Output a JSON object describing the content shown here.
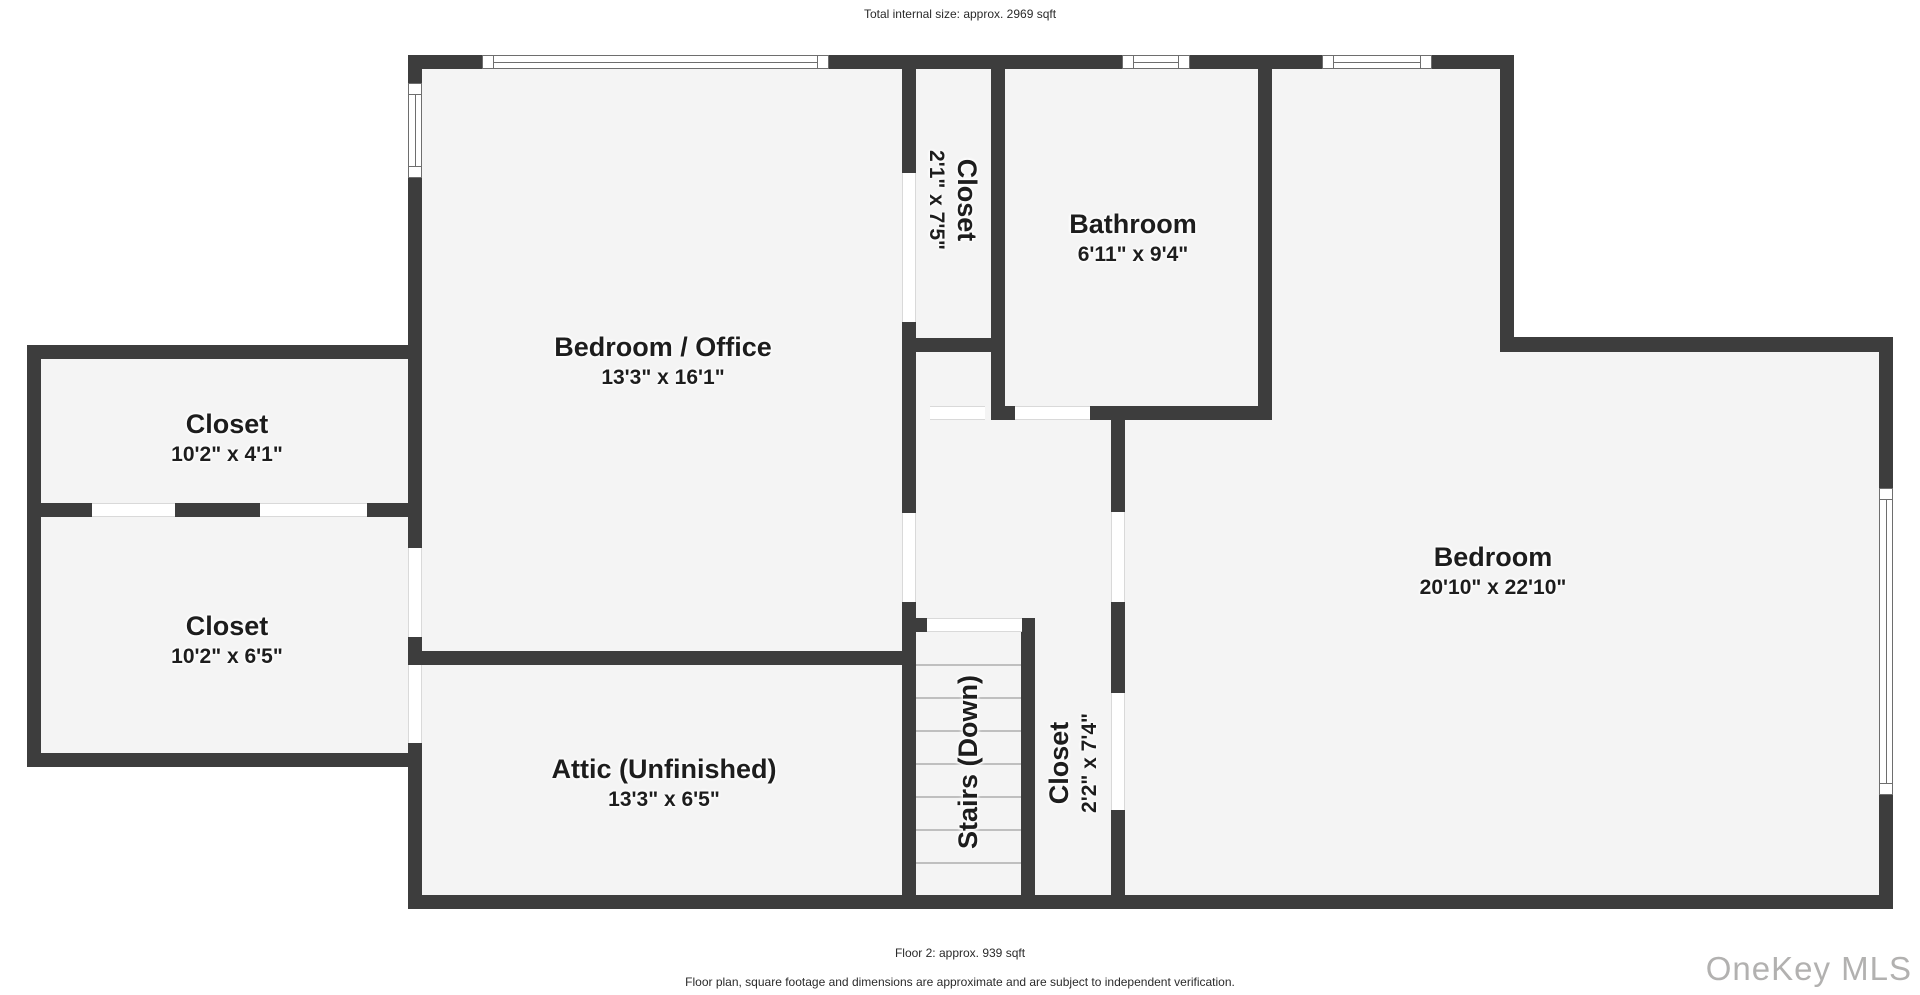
{
  "header": {
    "total_size": "Total internal size: approx. 2969 sqft"
  },
  "footer": {
    "floor_label": "Floor 2: approx. 939 sqft",
    "disclaimer": "Floor plan, square footage and dimensions are approximate and are subject to independent verification.",
    "watermark": "OneKey MLS"
  },
  "rooms": {
    "bedroom_office": {
      "name": "Bedroom / Office",
      "dims": "13'3\" x 16'1\""
    },
    "closet_center": {
      "name": "Closet",
      "dims": "2'1\" x 7'5\""
    },
    "bathroom": {
      "name": "Bathroom",
      "dims": "6'11\" x 9'4\""
    },
    "bedroom": {
      "name": "Bedroom",
      "dims": "20'10\" x 22'10\""
    },
    "closet_top_left": {
      "name": "Closet",
      "dims": "10'2\" x 4'1\""
    },
    "closet_bottom_left": {
      "name": "Closet",
      "dims": "10'2\" x 6'5\""
    },
    "attic": {
      "name": "Attic (Unfinished)",
      "dims": "13'3\" x 6'5\""
    },
    "stairs": {
      "name": "Stairs (Down)"
    },
    "closet_right": {
      "name": "Closet",
      "dims": "2'2\" x 7'4\""
    }
  },
  "colors": {
    "wall": "#3d3d3d",
    "floor": "#f4f4f4",
    "frame": "#6e6e6e",
    "tread": "#bfbfbf",
    "ink": "#1d1d1d",
    "caption": "#2a2a2a",
    "watermark": "#b2b1b0"
  }
}
